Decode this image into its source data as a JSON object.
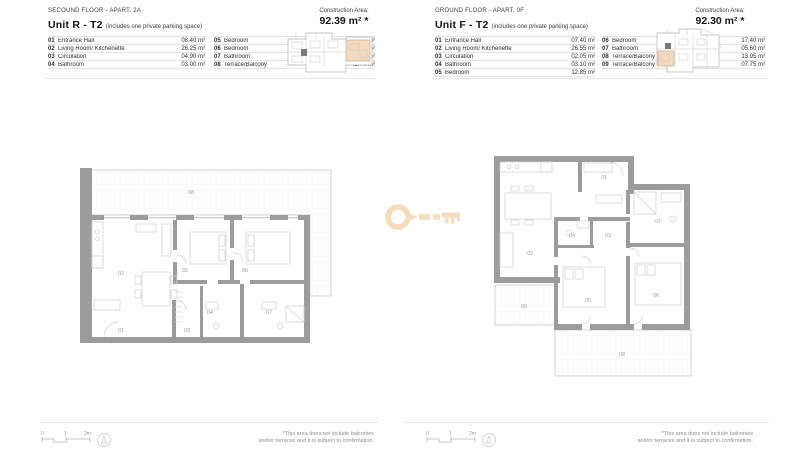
{
  "colors": {
    "accent_peach": "#f6dcbb",
    "highlight_unit": "#f3d9c0",
    "wall_gray": "#9c9c9c"
  },
  "units": [
    {
      "floor_label": "SECOUND FLOOR - APART. 2A",
      "unit_name": "Unit R - T2",
      "unit_note": "(includes one private parking space)",
      "construction_area_label": "Construction Area:",
      "construction_area_value": "92.39 m² *",
      "rooms_col1": [
        {
          "num": "01",
          "name": "Entrance Hall",
          "area": "08.40 m²"
        },
        {
          "num": "02",
          "name": "Living Room/ Kitchenette",
          "area": "26.25 m²"
        },
        {
          "num": "03",
          "name": "Circulation",
          "area": "04.90 m²"
        },
        {
          "num": "04",
          "name": "Bathroom",
          "area": "03.00 m²"
        }
      ],
      "rooms_col2": [
        {
          "num": "05",
          "name": "Bedroom",
          "area": "11.05 m²"
        },
        {
          "num": "06",
          "name": "Bedroom",
          "area": "16.25 m²"
        },
        {
          "num": "07",
          "name": "Bathroom",
          "area": "04.70 m²"
        },
        {
          "num": "08",
          "name": "Terrace/Balcony",
          "area": "41.70 m²"
        }
      ],
      "plan_labels": {
        "n01": "01",
        "n02": "02",
        "n03": "03",
        "n04": "04",
        "n05": "05",
        "n06": "06",
        "n07": "07",
        "n08": "08"
      },
      "scale": [
        "0",
        "1",
        "2m"
      ],
      "disclaimer": [
        "*This area does not include balconies",
        "and/or terraces and it is subject to confirmation."
      ]
    },
    {
      "floor_label": "GROUND FLOOR - APART. 0F",
      "unit_name": "Unit F - T2",
      "unit_note": "(includes one private parking space)",
      "construction_area_label": "Construction Area:",
      "construction_area_value": "92.30 m² *",
      "rooms_col1": [
        {
          "num": "01",
          "name": "Entrance Hall",
          "area": "07.40 m²"
        },
        {
          "num": "02",
          "name": "Living Room/ Kitchenette",
          "area": "26.55 m²"
        },
        {
          "num": "03",
          "name": "Circulation",
          "area": "02.05 m²"
        },
        {
          "num": "04",
          "name": "Bathroom",
          "area": "03.10 m²"
        },
        {
          "num": "05",
          "name": "Bedroom",
          "area": "12.85 m²"
        }
      ],
      "rooms_col2": [
        {
          "num": "06",
          "name": "Bedroom",
          "area": "17.40 m²"
        },
        {
          "num": "07",
          "name": "Bathroom",
          "area": "05.60 m²"
        },
        {
          "num": "08",
          "name": "Terrace/Balcony",
          "area": "13.95 m²"
        },
        {
          "num": "09",
          "name": "Terrace/Balcony",
          "area": "07.75 m²"
        }
      ],
      "plan_labels": {
        "n01": "01",
        "n02": "02",
        "n03": "03",
        "n04": "04",
        "n05": "05",
        "n06": "06",
        "n07": "07",
        "n08": "08",
        "n09": "09"
      },
      "scale": [
        "0",
        "1",
        "2m"
      ],
      "disclaimer": [
        "*This area does not include balconies",
        "and/or terraces and it is subject to confirmation."
      ]
    }
  ]
}
